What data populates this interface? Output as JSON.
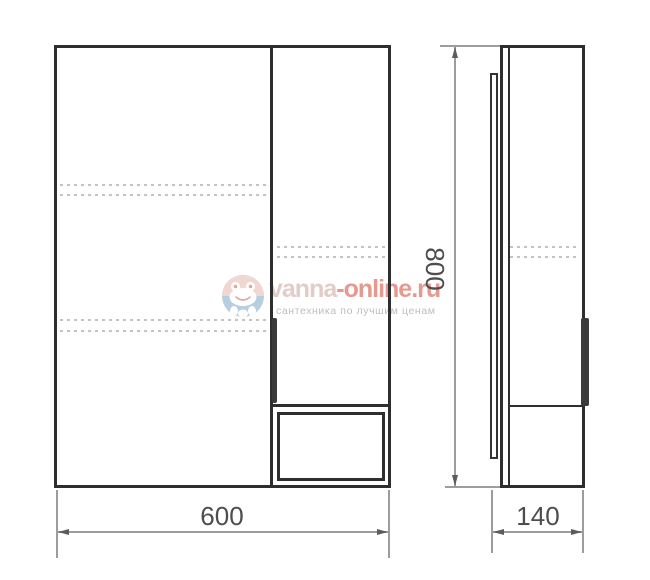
{
  "drawing": {
    "type": "furniture technical drawing (mirror cabinet, front and side views)",
    "line_color": "#2e2e2e",
    "dimension_line_color": "#9d9d9d",
    "dimensions": {
      "width_label": "600",
      "height_label": "800",
      "depth_label": "140"
    }
  },
  "watermark": {
    "brand_first": "vanna",
    "brand_second": "-online.ru",
    "tagline": "сантехника по лучшим ценам",
    "logo_colors": {
      "top_half": "#f1d6d1",
      "bottom_half": "#b7cee1",
      "face": "#ffffff",
      "accents": "#e8a59d"
    }
  }
}
